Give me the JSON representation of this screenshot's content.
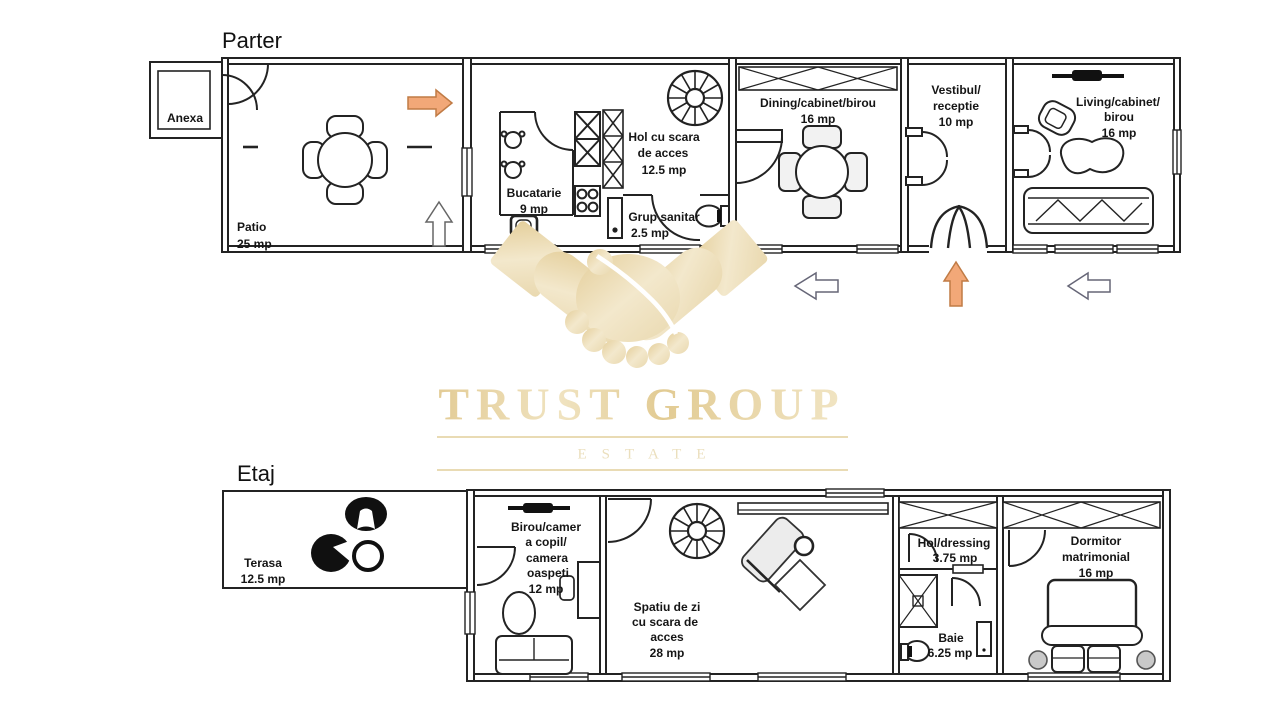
{
  "floors": {
    "parter": {
      "title": "Parter",
      "rooms": {
        "anexa": {
          "name": "Anexa"
        },
        "patio": {
          "name": "Patio",
          "area": "25 mp"
        },
        "bucatarie": {
          "name": "Bucatarie",
          "area": "9 mp"
        },
        "hol_scara": {
          "line1": "Hol cu scara",
          "line2": "de acces",
          "area": "12.5 mp"
        },
        "grup_sanitar": {
          "name": "Grup sanitar",
          "area": "2.5 mp"
        },
        "dining": {
          "name": "Dining/cabinet/birou",
          "area": "16 mp"
        },
        "vestibul": {
          "line1": "Vestibul/",
          "line2": "receptie",
          "area": "10 mp"
        },
        "living": {
          "line1": "Living/cabinet/",
          "line2": "birou",
          "area": "16 mp"
        }
      }
    },
    "etaj": {
      "title": "Etaj",
      "rooms": {
        "terasa": {
          "name": "Terasa",
          "area": "12.5 mp"
        },
        "birou_copil": {
          "line1": "Birou/camer",
          "line2": "a copil/",
          "line3": "camera",
          "line4": "oaspeti",
          "area": "12 mp"
        },
        "spatiu_zi": {
          "line1": "Spatiu de zi",
          "line2": "cu scara de",
          "line3": "acces",
          "area": "28 mp"
        },
        "hol_dressing": {
          "name": "Hol/dressing",
          "area": "3.75 mp"
        },
        "baie": {
          "name": "Baie",
          "area": "6.25 mp"
        },
        "dormitor": {
          "line1": "Dormitor",
          "line2": "matrimonial",
          "area": "16 mp"
        }
      }
    }
  },
  "watermark": {
    "brand": "TRUST GROUP",
    "subtitle": "ESTATE"
  },
  "colors": {
    "accent_orange": "#F2A878",
    "watermark_gold": "#E8D6AA",
    "plan_line": "#222222"
  }
}
